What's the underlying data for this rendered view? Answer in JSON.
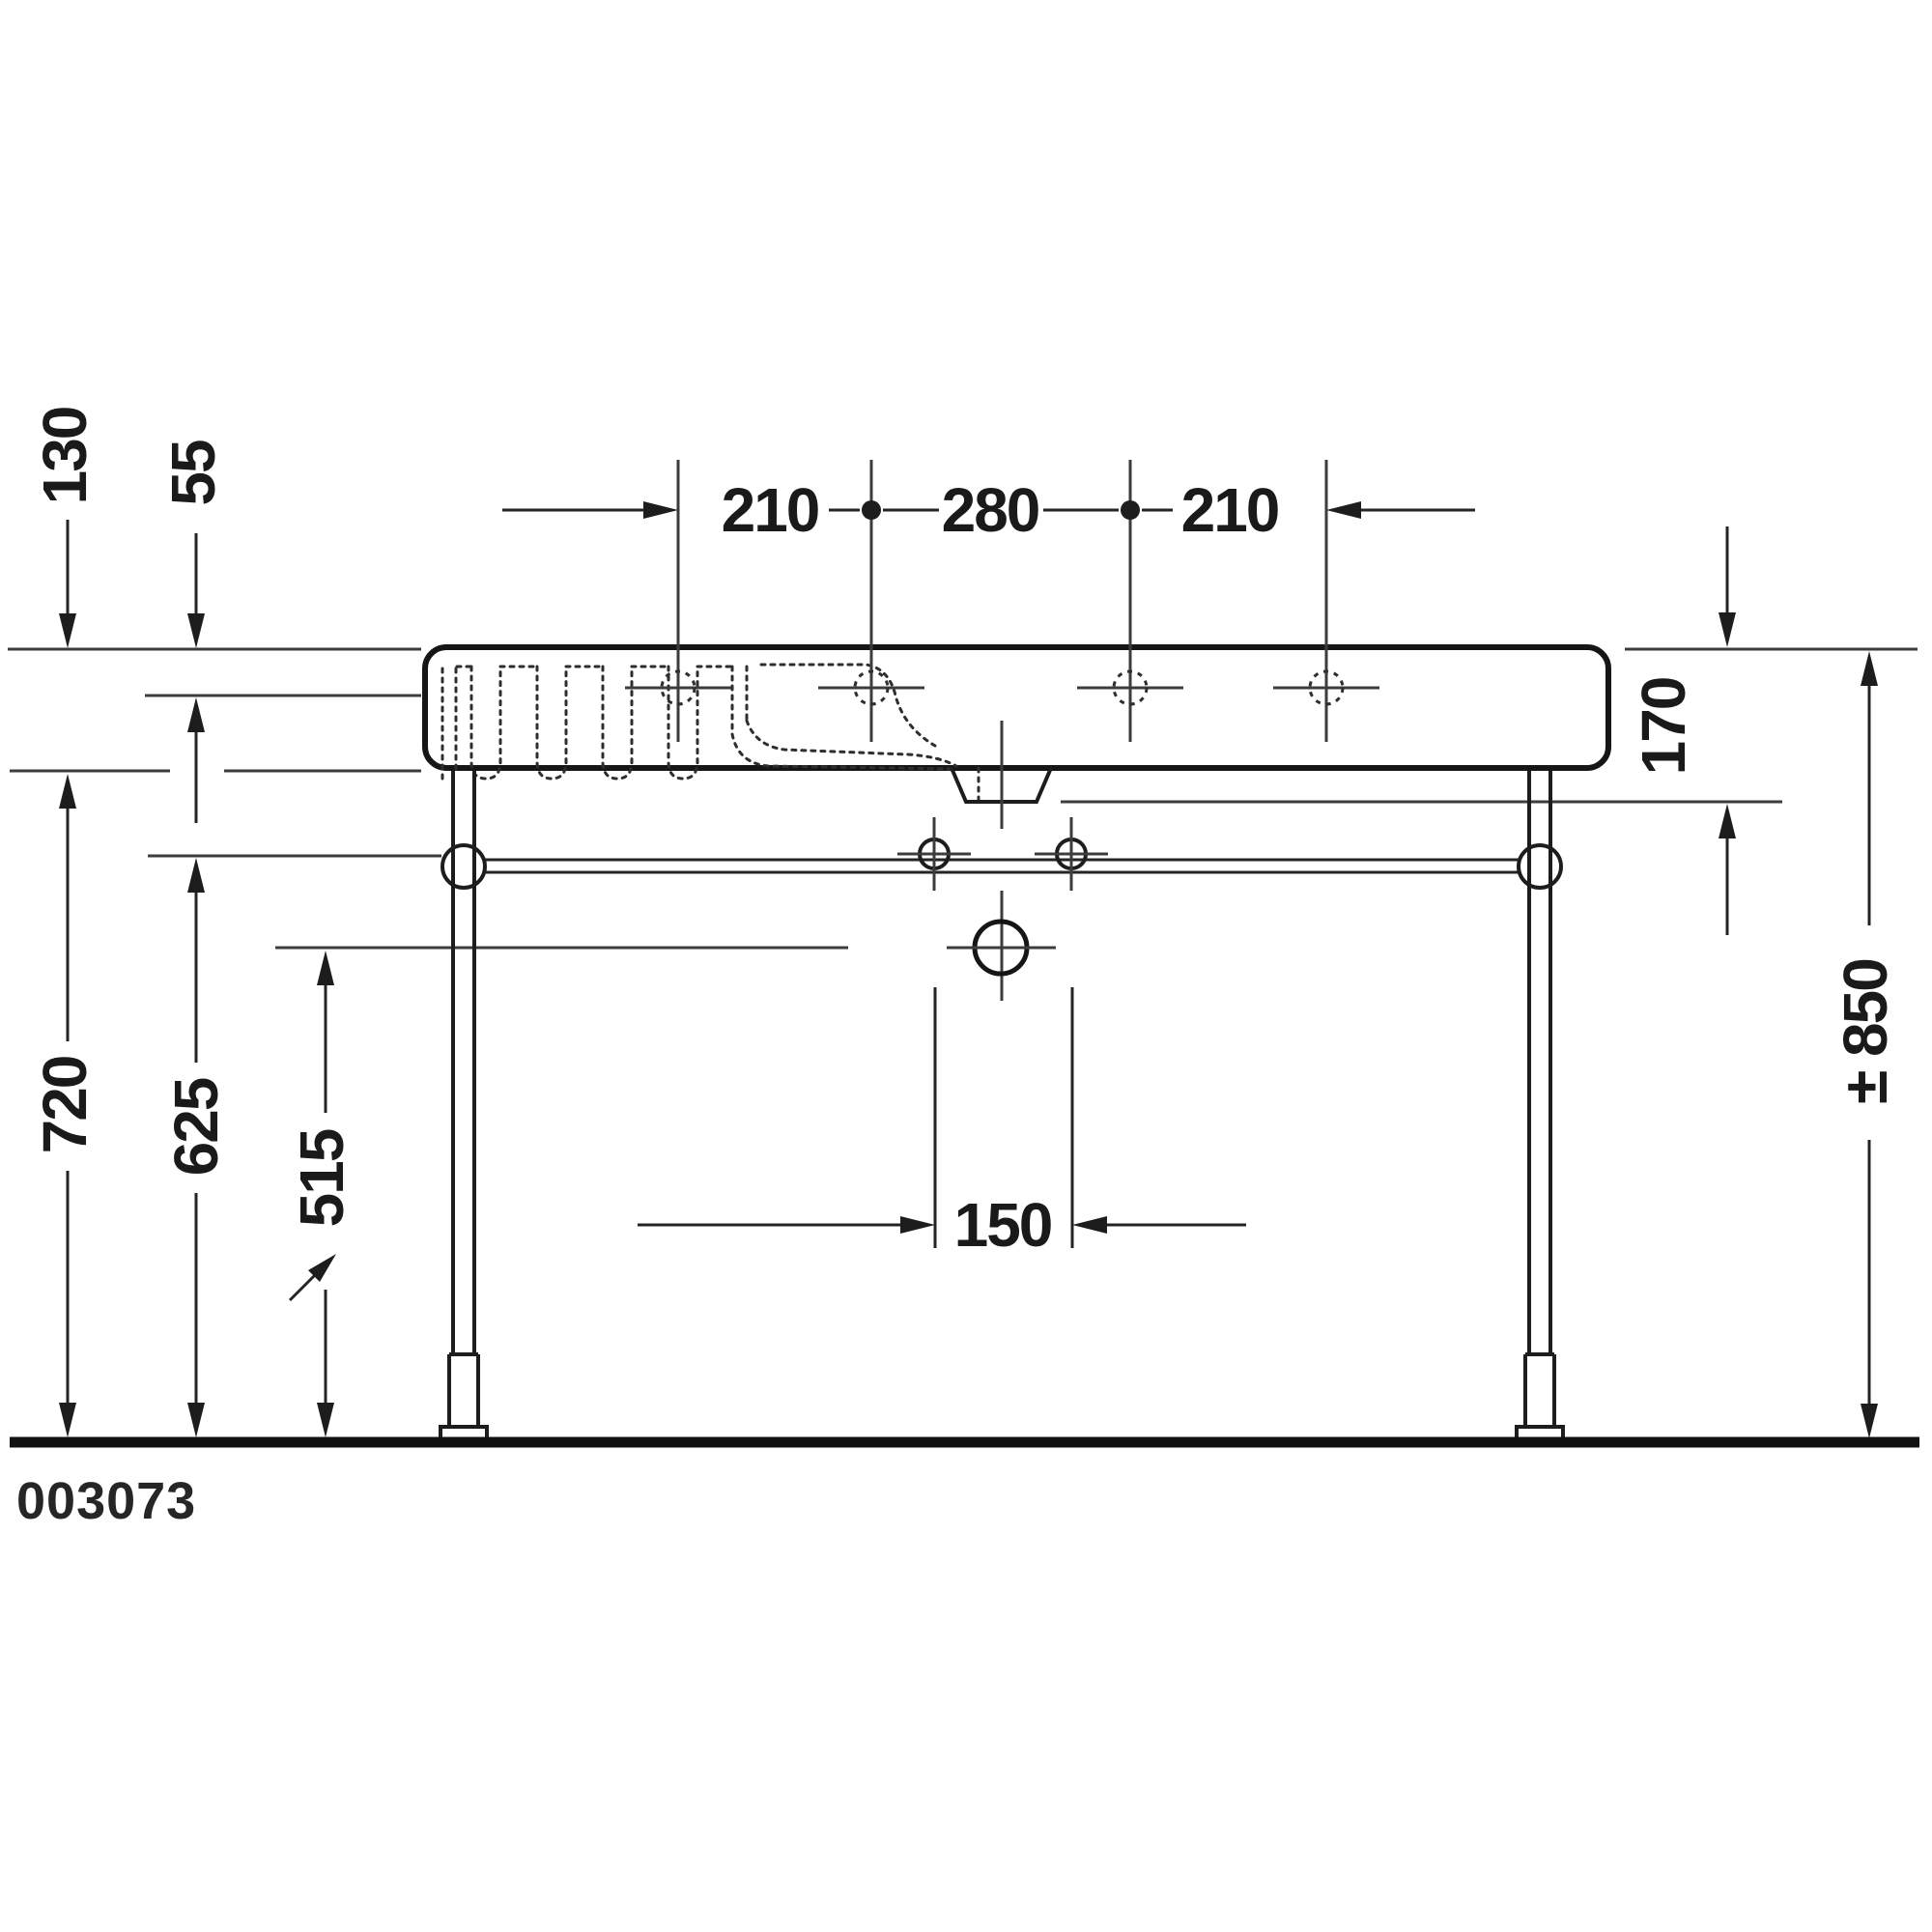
{
  "labels": {
    "top_left": "210",
    "top_center": "280",
    "top_right": "210",
    "thickness": "130",
    "rim": "55",
    "underside": "720",
    "rail": "625",
    "drain": "515",
    "boss": "170",
    "total": "± 850",
    "spacing": "150",
    "model": "003073"
  },
  "colors": {
    "line": "#1a1a1a",
    "background": "#ffffff"
  }
}
